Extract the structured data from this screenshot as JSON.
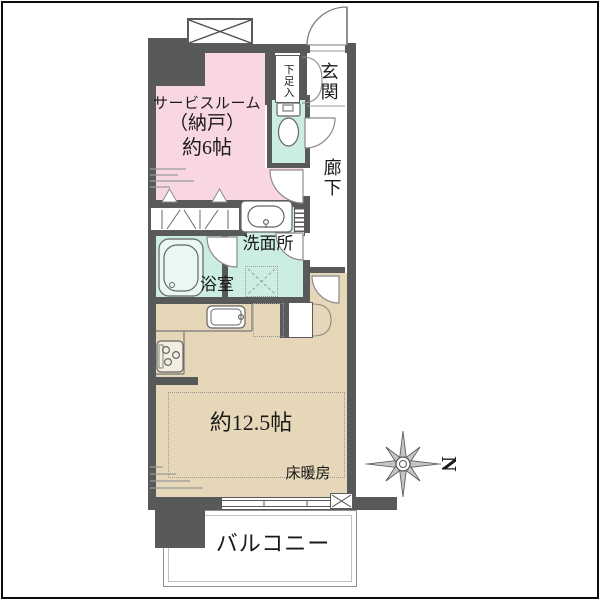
{
  "floor_plan": {
    "rooms": {
      "service_room": {
        "name_line": "サービスルーム",
        "sub_line": "（納戸）",
        "size_line": "約6帖",
        "color": "#f8d7e0"
      },
      "entrance": {
        "label": "玄関"
      },
      "shoe_cabinet": {
        "label": "下足入"
      },
      "hallway": {
        "label": "廊下"
      },
      "toilet": {
        "color": "#cceee0"
      },
      "washroom": {
        "label": "洗面所",
        "color": "#cceee0"
      },
      "bathroom": {
        "label": "浴室",
        "color": "#cceee0"
      },
      "living_dining_kitchen": {
        "size_label": "約12.5帖",
        "floor_heating_label": "床暖房",
        "color": "#e6d7b8"
      },
      "balcony": {
        "label": "バルコニー"
      }
    },
    "compass": {
      "north_label": "N"
    },
    "wall_color": "#58595b"
  }
}
